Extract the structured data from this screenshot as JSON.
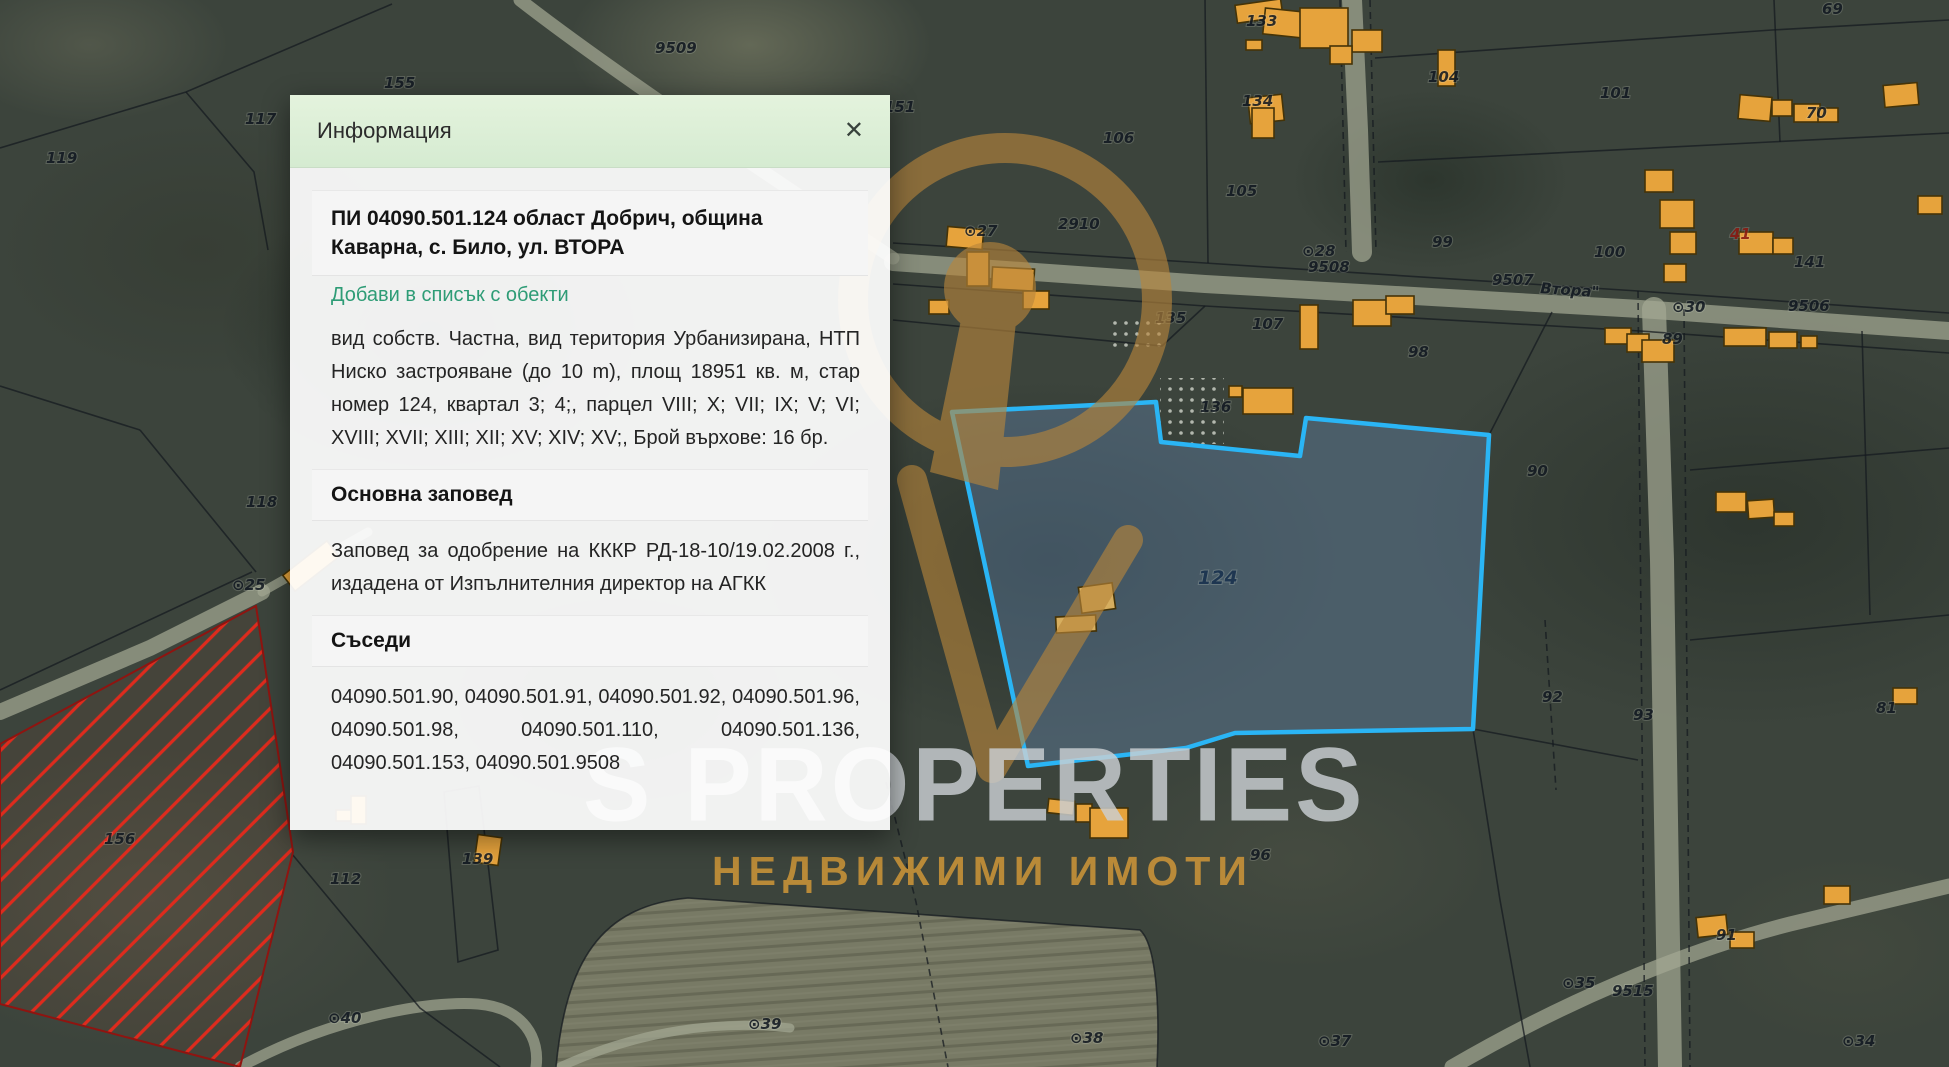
{
  "dialog": {
    "header": "Информация",
    "close_glyph": "✕",
    "title": "ПИ 04090.501.124 област Добрич, община Каварна, с. Било, ул. ВТОРА",
    "add_link": "Добави в списък с обекти",
    "details": "вид собств. Частна, вид територия Урбанизирана, НТП Ниско застрояване (до 10 m), площ 18951 кв. м, стар номер 124, квартал 3; 4;, парцел VIII; X; VII; IX; V; VI; XVIII; XVII; XIII; XII; XV; XIV; XV;, Брой върхове: 16 бр.",
    "order_header": "Основна заповед",
    "order_text": "Заповед за одобрение на КККР РД-18-10/19.02.2008 г., издадена от Изпълнителния директор на АГКК",
    "neighbors_header": "Съседи",
    "neighbors_text": "04090.501.90, 04090.501.91, 04090.501.92, 04090.501.96, 04090.501.98, 04090.501.110, 04090.501.136, 04090.501.153, 04090.501.9508"
  },
  "watermark": {
    "brand": "S PROPERTIES",
    "tagline": "НЕДВИЖИМИ ИМОТИ",
    "logo_color": "#b8863b"
  },
  "map": {
    "colors": {
      "selected_fill": "rgba(98,130,170,0.42)",
      "selected_stroke": "#2ab5f5",
      "hatch_line": "#de2b1d",
      "hatch_border": "#8f1410",
      "building_fill": "#e6a33c"
    },
    "selected_parcel": {
      "label": "124",
      "points": "952,412 1156,402 1161,442 1300,456 1306,418 1489,435 1473,729 1235,733 1186,748 1028,766"
    },
    "restricted_parcel": {
      "points": "0,744 256,606 293,852 240,1067 0,1004"
    },
    "field": {
      "path": "M 556,1067 C 566,962 600,906 688,898 L 1140,930 C 1156,944 1160,1004 1157,1067 Z"
    },
    "speckles": [
      {
        "x": 1160,
        "y": 378,
        "w": 64,
        "h": 66
      },
      {
        "x": 1112,
        "y": 316,
        "w": 52,
        "h": 38
      }
    ],
    "roads": [
      {
        "d": "M 893,262 L 1205,284 L 1640,309 L 1949,331",
        "w": 18,
        "o": 0.72
      },
      {
        "d": "M 1352,0 L 1358,130 L 1362,252",
        "w": 20,
        "o": 0.7
      },
      {
        "d": "M 1654,309 L 1662,560 L 1666,820 L 1670,1067",
        "w": 24,
        "o": 0.7
      },
      {
        "d": "M 0,712 L 150,648 L 262,592",
        "w": 16,
        "o": 0.7
      },
      {
        "d": "M 262,592 L 368,532",
        "w": 9,
        "o": 0.4
      },
      {
        "d": "M 520,0 C 610,70 760,170 893,258",
        "w": 13,
        "o": 0.45
      },
      {
        "d": "M 1452,1067 C 1560,1004 1680,952 1790,924 L 1949,886",
        "w": 15,
        "o": 0.6
      },
      {
        "d": "M 240,1067 C 330,1018 430,1000 478,1004 C 525,1008 540,1040 536,1067",
        "w": 11,
        "o": 0.5
      },
      {
        "d": "M 560,1067 C 640,1030 720,1020 790,1028",
        "w": 9,
        "o": 0.35
      }
    ],
    "boundaries": [
      {
        "d": "M 0,148 L 186,92 L 392,4"
      },
      {
        "d": "M 186,92 L 254,172 L 268,250"
      },
      {
        "d": "M 893,243 L 1205,263 L 1638,291 L 1949,313"
      },
      {
        "d": "M 893,284 L 1205,306 L 1640,331 L 1949,353"
      },
      {
        "d": "M 1205,0 L 1208,263"
      },
      {
        "d": "M 1375,58 L 1772,30 L 1949,20"
      },
      {
        "d": "M 1378,162 L 1770,142 L 1949,133"
      },
      {
        "d": "M 1774,0 L 1780,142"
      },
      {
        "d": "M 1340,0 L 1346,252",
        "dash": true
      },
      {
        "d": "M 1370,0 L 1376,252",
        "dash": true
      },
      {
        "d": "M 1638,291 L 1645,1067",
        "dash": true
      },
      {
        "d": "M 1684,309 L 1690,1067",
        "dash": true
      },
      {
        "d": "M 1489,435 L 1552,312"
      },
      {
        "d": "M 1473,729 L 1638,760"
      },
      {
        "d": "M 1690,470 L 1949,448"
      },
      {
        "d": "M 1690,640 L 1949,615"
      },
      {
        "d": "M 1862,331 L 1870,615"
      },
      {
        "d": "M 1545,620 L 1556,790",
        "dash": true
      },
      {
        "d": "M 886,782 L 916,902 L 948,1067",
        "dash": true
      },
      {
        "d": "M 556,1067 C 566,962 600,906 688,898 L 1140,930 C 1156,944 1160,1004 1157,1067"
      },
      {
        "d": "M 292,854 L 420,1008 L 500,1067"
      },
      {
        "d": "M 444,792 L 479,786 L 498,950 L 458,962 Z"
      },
      {
        "d": "M 140,430 L 256,572"
      },
      {
        "d": "M 0,386 L 140,430"
      },
      {
        "d": "M 0,690 L 252,572"
      },
      {
        "d": "M 893,320 L 1162,346 L 1205,306"
      },
      {
        "d": "M 1473,729 L 1500,900 L 1530,1067"
      }
    ],
    "buildings": [
      {
        "x": 283,
        "y": 556,
        "w": 56,
        "h": 20,
        "r": -38
      },
      {
        "x": 336,
        "y": 810,
        "w": 28,
        "h": 11,
        "r": 0
      },
      {
        "x": 351,
        "y": 796,
        "w": 15,
        "h": 28,
        "r": 0
      },
      {
        "x": 476,
        "y": 836,
        "w": 24,
        "h": 28,
        "r": 8
      },
      {
        "x": 947,
        "y": 228,
        "w": 36,
        "h": 20,
        "r": 5
      },
      {
        "x": 967,
        "y": 252,
        "w": 22,
        "h": 34,
        "r": 0
      },
      {
        "x": 992,
        "y": 268,
        "w": 42,
        "h": 22,
        "r": 3
      },
      {
        "x": 1023,
        "y": 291,
        "w": 26,
        "h": 18,
        "r": 0
      },
      {
        "x": 929,
        "y": 300,
        "w": 20,
        "h": 14,
        "r": 0
      },
      {
        "x": 1229,
        "y": 386,
        "w": 13,
        "h": 11,
        "r": 0
      },
      {
        "x": 1243,
        "y": 388,
        "w": 50,
        "h": 26,
        "r": 0
      },
      {
        "x": 1236,
        "y": 2,
        "w": 46,
        "h": 18,
        "r": -8
      },
      {
        "x": 1264,
        "y": 10,
        "w": 40,
        "h": 26,
        "r": 6
      },
      {
        "x": 1246,
        "y": 40,
        "w": 16,
        "h": 10,
        "r": 0
      },
      {
        "x": 1300,
        "y": 8,
        "w": 48,
        "h": 40,
        "r": 0
      },
      {
        "x": 1352,
        "y": 30,
        "w": 30,
        "h": 22,
        "r": 0
      },
      {
        "x": 1438,
        "y": 50,
        "w": 17,
        "h": 36,
        "r": 0
      },
      {
        "x": 1330,
        "y": 46,
        "w": 22,
        "h": 18,
        "r": 0
      },
      {
        "x": 1249,
        "y": 96,
        "w": 34,
        "h": 26,
        "r": -6
      },
      {
        "x": 1252,
        "y": 108,
        "w": 22,
        "h": 30,
        "r": 0
      },
      {
        "x": 1645,
        "y": 170,
        "w": 28,
        "h": 22,
        "r": 0
      },
      {
        "x": 1660,
        "y": 200,
        "w": 34,
        "h": 28,
        "r": 0
      },
      {
        "x": 1670,
        "y": 232,
        "w": 26,
        "h": 22,
        "r": 0
      },
      {
        "x": 1739,
        "y": 96,
        "w": 32,
        "h": 24,
        "r": 5
      },
      {
        "x": 1772,
        "y": 100,
        "w": 20,
        "h": 16,
        "r": 0
      },
      {
        "x": 1794,
        "y": 104,
        "w": 26,
        "h": 18,
        "r": 0
      },
      {
        "x": 1818,
        "y": 108,
        "w": 20,
        "h": 14,
        "r": 0
      },
      {
        "x": 1884,
        "y": 84,
        "w": 34,
        "h": 22,
        "r": -5
      },
      {
        "x": 1918,
        "y": 196,
        "w": 24,
        "h": 18,
        "r": 0
      },
      {
        "x": 1300,
        "y": 305,
        "w": 18,
        "h": 44,
        "r": 0
      },
      {
        "x": 1353,
        "y": 300,
        "w": 38,
        "h": 26,
        "r": 0
      },
      {
        "x": 1386,
        "y": 296,
        "w": 28,
        "h": 18,
        "r": 0
      },
      {
        "x": 1605,
        "y": 328,
        "w": 26,
        "h": 16,
        "r": 0
      },
      {
        "x": 1627,
        "y": 334,
        "w": 22,
        "h": 18,
        "r": 0
      },
      {
        "x": 1642,
        "y": 340,
        "w": 32,
        "h": 22,
        "r": 0
      },
      {
        "x": 1724,
        "y": 328,
        "w": 42,
        "h": 18,
        "r": 0
      },
      {
        "x": 1769,
        "y": 332,
        "w": 28,
        "h": 16,
        "r": 0
      },
      {
        "x": 1801,
        "y": 336,
        "w": 16,
        "h": 12,
        "r": 0
      },
      {
        "x": 1739,
        "y": 232,
        "w": 34,
        "h": 22,
        "r": 0
      },
      {
        "x": 1773,
        "y": 238,
        "w": 20,
        "h": 16,
        "r": 0
      },
      {
        "x": 1664,
        "y": 264,
        "w": 22,
        "h": 18,
        "r": 0
      },
      {
        "x": 1716,
        "y": 492,
        "w": 30,
        "h": 20,
        "r": 0
      },
      {
        "x": 1748,
        "y": 500,
        "w": 26,
        "h": 18,
        "r": -4
      },
      {
        "x": 1774,
        "y": 512,
        "w": 20,
        "h": 14,
        "r": 0
      },
      {
        "x": 1893,
        "y": 688,
        "w": 24,
        "h": 16,
        "r": 0
      },
      {
        "x": 1697,
        "y": 916,
        "w": 30,
        "h": 20,
        "r": -6
      },
      {
        "x": 1730,
        "y": 932,
        "w": 24,
        "h": 16,
        "r": 0
      },
      {
        "x": 1824,
        "y": 886,
        "w": 26,
        "h": 18,
        "r": 0
      },
      {
        "x": 1048,
        "y": 800,
        "w": 26,
        "h": 14,
        "r": 6
      },
      {
        "x": 1076,
        "y": 804,
        "w": 16,
        "h": 18,
        "r": 0
      },
      {
        "x": 1090,
        "y": 808,
        "w": 38,
        "h": 30,
        "r": 0
      },
      {
        "x": 1080,
        "y": 585,
        "w": 34,
        "h": 26,
        "r": -8,
        "muted": true
      },
      {
        "x": 1056,
        "y": 616,
        "w": 40,
        "h": 16,
        "r": -3,
        "muted": true
      }
    ],
    "labels": [
      {
        "t": "117",
        "x": 245,
        "y": 124
      },
      {
        "t": "119",
        "x": 46,
        "y": 163
      },
      {
        "t": "155",
        "x": 384,
        "y": 88
      },
      {
        "t": "9509",
        "x": 655,
        "y": 53
      },
      {
        "t": "118",
        "x": 246,
        "y": 507
      },
      {
        "t": "156",
        "x": 104,
        "y": 844
      },
      {
        "t": "112",
        "x": 330,
        "y": 884
      },
      {
        "t": "139",
        "x": 462,
        "y": 864
      },
      {
        "t": "⊙25",
        "x": 232,
        "y": 590
      },
      {
        "t": "⊙40",
        "x": 328,
        "y": 1023
      },
      {
        "t": "⊙39",
        "x": 748,
        "y": 1029
      },
      {
        "t": "⊙38",
        "x": 1070,
        "y": 1043
      },
      {
        "t": "⊙37",
        "x": 1318,
        "y": 1046
      },
      {
        "t": "⊙34",
        "x": 1842,
        "y": 1046
      },
      {
        "t": "⊙35",
        "x": 1562,
        "y": 988
      },
      {
        "t": "9515",
        "x": 1612,
        "y": 996
      },
      {
        "t": "⊙27",
        "x": 964,
        "y": 236
      },
      {
        "t": "2910",
        "x": 1058,
        "y": 229
      },
      {
        "t": "151",
        "x": 884,
        "y": 112
      },
      {
        "t": "106",
        "x": 1103,
        "y": 143
      },
      {
        "t": "135",
        "x": 1155,
        "y": 323
      },
      {
        "t": "107",
        "x": 1252,
        "y": 329
      },
      {
        "t": "136",
        "x": 1200,
        "y": 412
      },
      {
        "t": "124",
        "x": 1198,
        "y": 584,
        "cls": "sel"
      },
      {
        "t": "⊙28",
        "x": 1302,
        "y": 256
      },
      {
        "t": "9508",
        "x": 1308,
        "y": 272
      },
      {
        "t": "99",
        "x": 1432,
        "y": 247
      },
      {
        "t": "9507",
        "x": 1492,
        "y": 285
      },
      {
        "t": "Втора\"",
        "x": 1540,
        "y": 293,
        "rot": 4
      },
      {
        "t": "100",
        "x": 1594,
        "y": 257
      },
      {
        "t": "⊙30",
        "x": 1672,
        "y": 312
      },
      {
        "t": "9506",
        "x": 1788,
        "y": 311
      },
      {
        "t": "133",
        "x": 1246,
        "y": 26
      },
      {
        "t": "134",
        "x": 1242,
        "y": 106
      },
      {
        "t": "104",
        "x": 1428,
        "y": 82
      },
      {
        "t": "101",
        "x": 1600,
        "y": 98
      },
      {
        "t": "105",
        "x": 1226,
        "y": 196
      },
      {
        "t": "69",
        "x": 1822,
        "y": 14
      },
      {
        "t": "70",
        "x": 1806,
        "y": 118
      },
      {
        "t": "141",
        "x": 1794,
        "y": 267
      },
      {
        "t": "41",
        "x": 1730,
        "y": 239,
        "cls": "red"
      },
      {
        "t": "89",
        "x": 1662,
        "y": 344
      },
      {
        "t": "90",
        "x": 1527,
        "y": 476
      },
      {
        "t": "98",
        "x": 1408,
        "y": 357
      },
      {
        "t": "92",
        "x": 1542,
        "y": 702
      },
      {
        "t": "93",
        "x": 1633,
        "y": 720
      },
      {
        "t": "81",
        "x": 1876,
        "y": 713
      },
      {
        "t": "91",
        "x": 1716,
        "y": 940
      },
      {
        "t": "96",
        "x": 1250,
        "y": 860
      }
    ]
  }
}
